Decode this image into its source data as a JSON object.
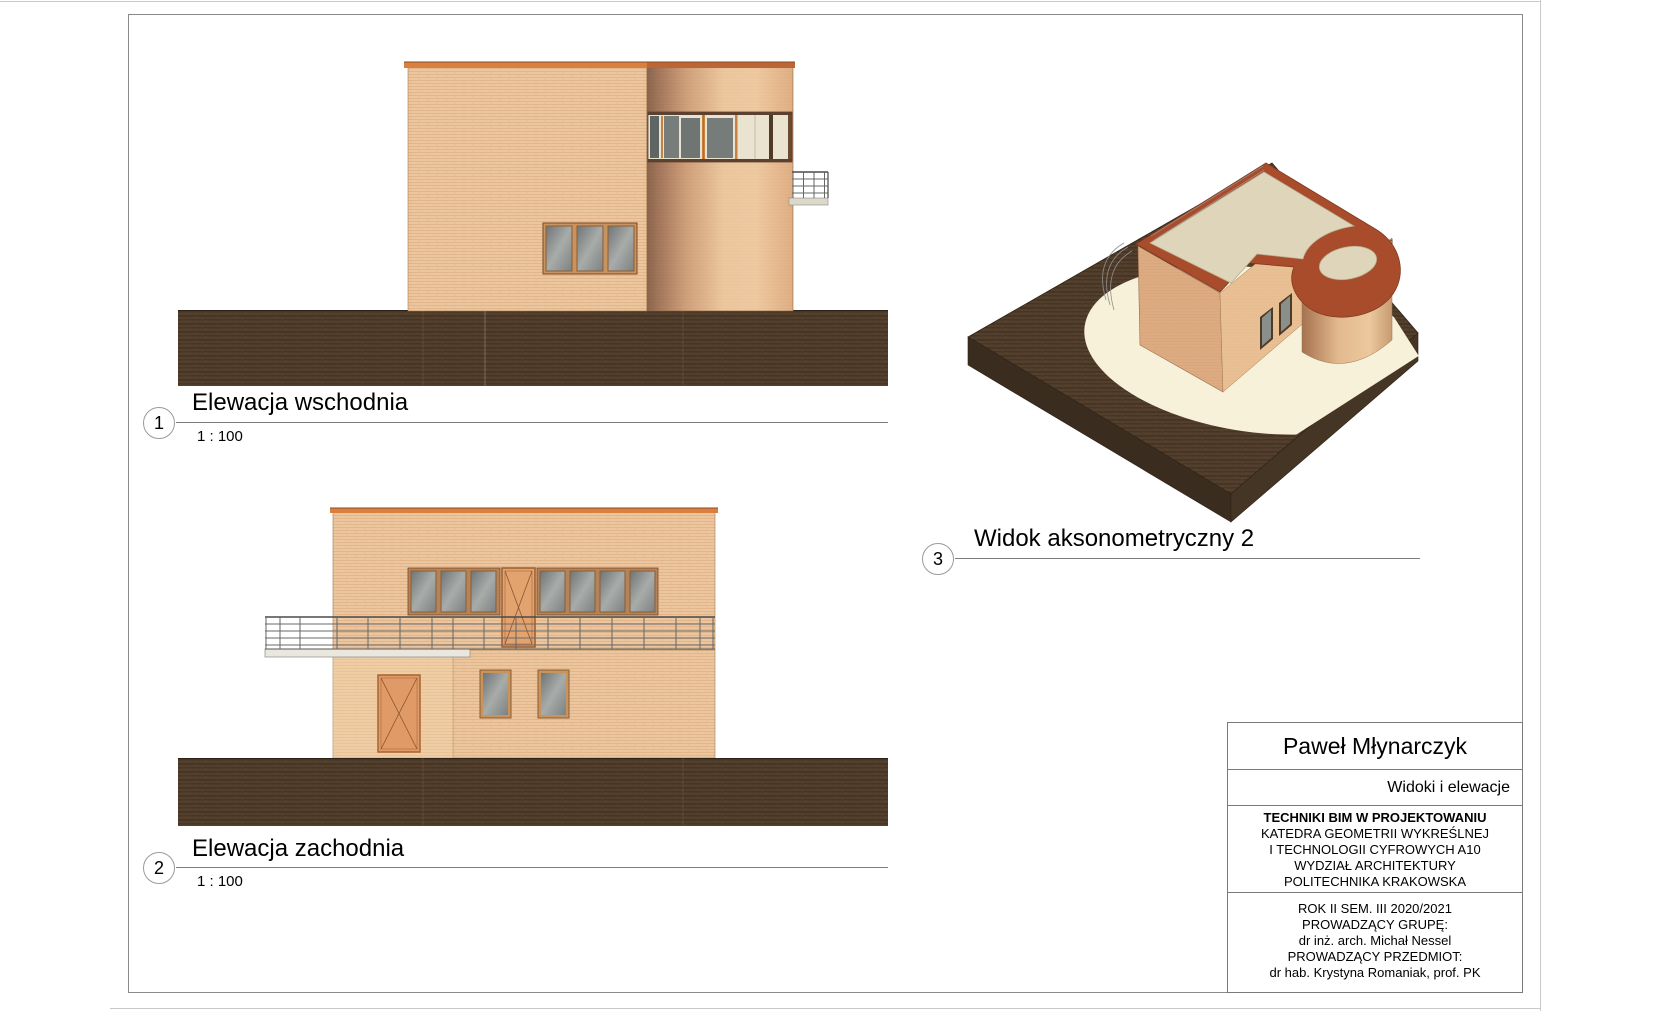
{
  "sheet": {
    "views": [
      {
        "number": "1",
        "title": "Elewacja wschodnia",
        "scale": "1 : 100"
      },
      {
        "number": "2",
        "title": "Elewacja zachodnia",
        "scale": "1 : 100"
      },
      {
        "number": "3",
        "title": "Widok aksonometryczny 2",
        "scale": ""
      }
    ],
    "title_block": {
      "author": "Paweł Młynarczyk",
      "sheet_name": "Widoki i elewacje",
      "institution_lines": [
        "TECHNIKI BIM W PROJEKTOWANIU",
        "KATEDRA GEOMETRII WYKREŚLNEJ",
        "I TECHNOLOGII CYFROWYCH A10",
        "WYDZIAŁ ARCHITEKTURY",
        "POLITECHNIKA KRAKOWSKA"
      ],
      "course_lines": [
        "ROK II SEM. III 2020/2021",
        "PROWADZĄCY GRUPĘ:",
        "dr inż. arch. Michał Nessel",
        "PROWADZĄCY PRZEDMIOT:",
        "dr hab. Krystyna Romaniak, prof. PK"
      ]
    },
    "colors": {
      "wall_brick": "#ecc69e",
      "coping_orange": "#d9803f",
      "coping_dark": "#a8532f",
      "ground_brown": "#4d3a28",
      "terrain_top": "#4e3b29",
      "path_cream": "#f7f1da",
      "roof_cream": "#ded5ba",
      "roof_coping_red": "#a84c2c",
      "glass_gray": "#7c8183",
      "window_wood": "#c9935f",
      "door_orange": "#e2a36e",
      "railing_gray": "#666666"
    }
  }
}
